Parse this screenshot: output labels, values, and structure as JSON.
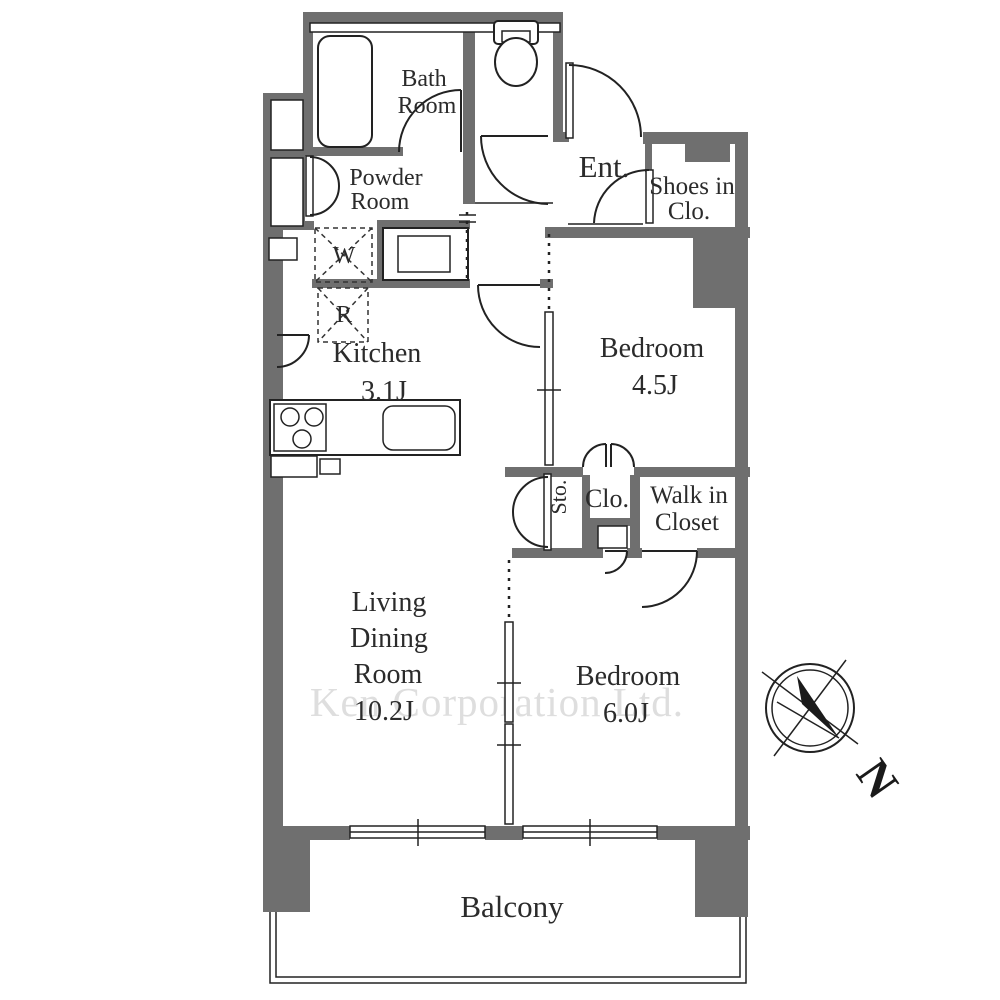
{
  "watermark": "Ken Corporation Ltd.",
  "compass": {
    "north": "N"
  },
  "rooms": {
    "bath": {
      "l1": "Bath",
      "l2": "Room"
    },
    "powder": {
      "l1": "Powder",
      "l2": "Room"
    },
    "entrance": {
      "l1": "Ent."
    },
    "shoes_closet": {
      "l1": "Shoes in",
      "l2": "Clo."
    },
    "bedroom_45": {
      "l1": "Bedroom",
      "l2": "4.5J"
    },
    "kitchen": {
      "l1": "Kitchen",
      "l2": "3.1J"
    },
    "storage": {
      "l1": "Sto."
    },
    "closet": {
      "l1": "Clo."
    },
    "walk_in_closet": {
      "l1": "Walk in",
      "l2": "Closet"
    },
    "living_dining": {
      "l1": "Living",
      "l2": "Dining",
      "l3": "Room",
      "l4": "10.2J"
    },
    "bedroom_60": {
      "l1": "Bedroom",
      "l2": "6.0J"
    },
    "balcony": {
      "l1": "Balcony"
    },
    "washer": {
      "l1": "W"
    },
    "refrigerator": {
      "l1": "R"
    }
  },
  "colors": {
    "wall": "#6f6f6f",
    "line": "#222222",
    "watermark": "#dedede",
    "background": "#ffffff"
  }
}
